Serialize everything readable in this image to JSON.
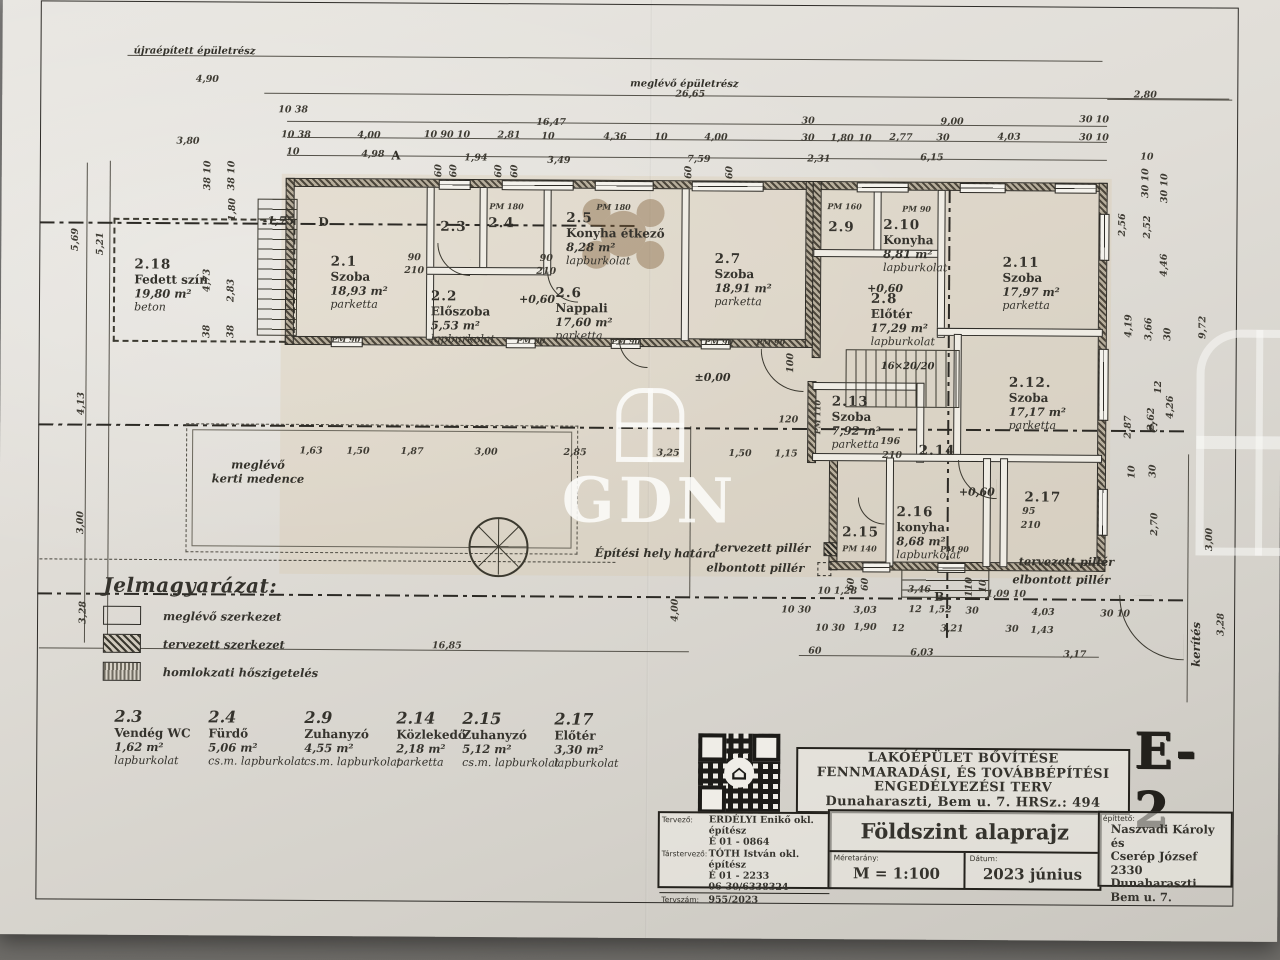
{
  "sheet": {
    "code": "E-2",
    "watermark": "GDN",
    "project_title_lines": [
      "LAKÓÉPÜLET BŐVÍTÉSE",
      "FENNMARADÁSI, ÉS TOVÁBBÉPÍTÉSI",
      "ENGEDÉLYEZÉSI TERV",
      "Dunaharaszti, Bem u. 7. HRSz.: 494"
    ],
    "drawing_title": "Földszint alaprajz",
    "scale_label": "Méretarány:",
    "scale_value": "M = 1:100",
    "date_label": "Dátum:",
    "date_value": "2023 június",
    "designer_label": "Tervező:",
    "designer_lines": [
      "ERDÉLYI Enikő okl. építész",
      "É 01 - 0864"
    ],
    "codesigner_label": "Társtervező:",
    "codesigner_lines": [
      "TÓTH István okl. építész",
      "É 01 - 2233",
      "06-30/6338324"
    ],
    "plan_no_label": "Tervszám:",
    "plan_no": "955/2023",
    "client_label": "építtető:",
    "client_lines": [
      "Naszvadi Károly és",
      "Cserép József",
      "2330 Dunaharaszti",
      "Bem u. 7."
    ]
  },
  "legend": {
    "title": "Jelmagyarázat:",
    "items": [
      {
        "label": "meglévő szerkezet"
      },
      {
        "label": "tervezett szerkezet"
      },
      {
        "label": "homlokzati hőszigetelés"
      }
    ]
  },
  "room_list": [
    {
      "id": "2.3",
      "name": "Vendég WC",
      "area": "1,62 m²",
      "floor": "lapburkolat"
    },
    {
      "id": "2.4",
      "name": "Fürdő",
      "area": "5,06 m²",
      "floor": "cs.m. lapburkolat"
    },
    {
      "id": "2.9",
      "name": "Zuhanyzó",
      "area": "4,55 m²",
      "floor": "cs.m. lapburkolat"
    },
    {
      "id": "2.14",
      "name": "Közlekedő",
      "area": "2,18 m²",
      "floor": "parketta"
    },
    {
      "id": "2.15",
      "name": "Zuhanyzó",
      "area": "5,12 m²",
      "floor": "cs.m. lapburkolat"
    },
    {
      "id": "2.17",
      "name": "Előtér",
      "area": "3,30 m²",
      "floor": "lapburkolat"
    }
  ],
  "plan": {
    "rooms": [
      {
        "id": "2.18",
        "name": "Fedett szín",
        "area": "19,80 m²",
        "floor": "beton",
        "x": 170,
        "y": 292
      },
      {
        "id": "2.1",
        "name": "Szoba",
        "area": "18,93 m²",
        "floor": "parketta",
        "x": 358,
        "y": 288
      },
      {
        "id": "2.2",
        "name": "Előszoba",
        "area": "5,53 m²",
        "floor": "lapburkolat",
        "x": 462,
        "y": 322
      },
      {
        "id": "2.3",
        "x": 452,
        "y": 232
      },
      {
        "id": "2.4",
        "x": 500,
        "y": 228
      },
      {
        "id": "2.5",
        "name": "Konyha étkező",
        "area": "8,28 m²",
        "floor": "lapburkolat",
        "x": 614,
        "y": 243
      },
      {
        "id": "2.6",
        "name": "Nappali",
        "area": "17,60 m²",
        "floor": "parketta",
        "x": 583,
        "y": 318
      },
      {
        "id": "2.7",
        "name": "Szoba",
        "area": "18,91 m²",
        "floor": "parketta",
        "x": 742,
        "y": 283
      },
      {
        "id": "2.8",
        "name": "Előtér",
        "area": "17,29 m²",
        "floor": "lapburkolat",
        "x": 902,
        "y": 322
      },
      {
        "id": "2.9",
        "x": 840,
        "y": 230
      },
      {
        "id": "2.10",
        "name": "Konyha",
        "area": "8,81 m²",
        "floor": "lapburkolat",
        "x": 914,
        "y": 248
      },
      {
        "id": "2.11",
        "name": "Szoba",
        "area": "17,97 m²",
        "floor": "parketta",
        "x": 1030,
        "y": 285
      },
      {
        "id": "2.12.",
        "name": "Szoba",
        "area": "17,17 m²",
        "floor": "parketta",
        "x": 1037,
        "y": 405
      },
      {
        "id": "2.13",
        "name": "Szoba",
        "area": "7,92 m²",
        "floor": "parketta",
        "x": 856,
        "y": 425
      },
      {
        "id": "2.14",
        "x": 937,
        "y": 453
      },
      {
        "id": "2.15",
        "x": 861,
        "y": 535
      },
      {
        "id": "2.16",
        "name": "konyha",
        "area": "8,68 m²",
        "floor": "lapburkolat",
        "x": 929,
        "y": 535
      },
      {
        "id": "2.17",
        "x": 1043,
        "y": 499
      }
    ],
    "dim_labels": [
      {
        "t": "4,90",
        "x": 205,
        "y": 86
      },
      {
        "t": "26,65",
        "x": 688,
        "y": 98
      },
      {
        "t": "2,80",
        "x": 1143,
        "y": 96
      },
      {
        "t": "16,47",
        "x": 549,
        "y": 127
      },
      {
        "t": "9,00",
        "x": 950,
        "y": 124
      },
      {
        "t": "30",
        "x": 806,
        "y": 124
      },
      {
        "t": "30 10",
        "x": 1092,
        "y": 121
      },
      {
        "t": "10 38",
        "x": 291,
        "y": 116
      },
      {
        "t": "10 38",
        "x": 294,
        "y": 141
      },
      {
        "t": "10",
        "x": 291,
        "y": 158
      },
      {
        "t": "4,00",
        "x": 367,
        "y": 141
      },
      {
        "t": "10 90 10",
        "x": 445,
        "y": 140
      },
      {
        "t": "2,81",
        "x": 507,
        "y": 140
      },
      {
        "t": "10",
        "x": 546,
        "y": 141
      },
      {
        "t": "4,36",
        "x": 613,
        "y": 141
      },
      {
        "t": "10",
        "x": 659,
        "y": 141
      },
      {
        "t": "4,00",
        "x": 714,
        "y": 141
      },
      {
        "t": "30",
        "x": 806,
        "y": 141
      },
      {
        "t": "1,80",
        "x": 840,
        "y": 141
      },
      {
        "t": "10",
        "x": 863,
        "y": 141
      },
      {
        "t": "2,77",
        "x": 899,
        "y": 140
      },
      {
        "t": "30",
        "x": 941,
        "y": 140
      },
      {
        "t": "4,03",
        "x": 1007,
        "y": 139
      },
      {
        "t": "30 10",
        "x": 1092,
        "y": 139
      },
      {
        "t": "4,98",
        "x": 371,
        "y": 160
      },
      {
        "t": "1,94",
        "x": 474,
        "y": 163
      },
      {
        "t": "3,49",
        "x": 557,
        "y": 165
      },
      {
        "t": "7,59",
        "x": 697,
        "y": 163
      },
      {
        "t": "2,31",
        "x": 817,
        "y": 162
      },
      {
        "t": "6,15",
        "x": 930,
        "y": 160
      },
      {
        "t": "10",
        "x": 1145,
        "y": 158
      },
      {
        "t": "3,80",
        "x": 186,
        "y": 148
      },
      {
        "t": "60",
        "x": 437,
        "y": 176,
        "v": 1
      },
      {
        "t": "60",
        "x": 452,
        "y": 176,
        "v": 1
      },
      {
        "t": "60",
        "x": 497,
        "y": 176,
        "v": 1
      },
      {
        "t": "60",
        "x": 513,
        "y": 176,
        "v": 1
      },
      {
        "t": "60",
        "x": 687,
        "y": 176,
        "v": 1
      },
      {
        "t": "60",
        "x": 728,
        "y": 176,
        "v": 1
      },
      {
        "t": "5,69",
        "x": 74,
        "y": 247,
        "v": 1
      },
      {
        "t": "5,21",
        "x": 99,
        "y": 251,
        "v": 1
      },
      {
        "t": "38 10",
        "x": 206,
        "y": 182,
        "v": 1
      },
      {
        "t": "38 10",
        "x": 230,
        "y": 182,
        "v": 1
      },
      {
        "t": "1,80",
        "x": 231,
        "y": 216,
        "v": 1
      },
      {
        "t": "4,73",
        "x": 206,
        "y": 287,
        "v": 1
      },
      {
        "t": "2,83",
        "x": 230,
        "y": 297,
        "v": 1
      },
      {
        "t": "38",
        "x": 206,
        "y": 338,
        "v": 1
      },
      {
        "t": "38",
        "x": 230,
        "y": 338,
        "v": 1
      },
      {
        "t": "4,13",
        "x": 81,
        "y": 411,
        "v": 1
      },
      {
        "t": "3,00",
        "x": 81,
        "y": 530,
        "v": 1
      },
      {
        "t": "3,28",
        "x": 84,
        "y": 620,
        "v": 1
      },
      {
        "t": "1,63",
        "x": 311,
        "y": 457
      },
      {
        "t": "1,50",
        "x": 358,
        "y": 457
      },
      {
        "t": "1,87",
        "x": 412,
        "y": 457
      },
      {
        "t": "3,00",
        "x": 486,
        "y": 457
      },
      {
        "t": "2,85",
        "x": 575,
        "y": 457
      },
      {
        "t": "3,25",
        "x": 668,
        "y": 457
      },
      {
        "t": "1,50",
        "x": 740,
        "y": 457
      },
      {
        "t": "1,15",
        "x": 786,
        "y": 457
      },
      {
        "t": "2,56",
        "x": 1121,
        "y": 226,
        "v": 1
      },
      {
        "t": "2,52",
        "x": 1146,
        "y": 228,
        "v": 1
      },
      {
        "t": "4,46",
        "x": 1163,
        "y": 266,
        "v": 1
      },
      {
        "t": "30 10",
        "x": 1144,
        "y": 184,
        "v": 1
      },
      {
        "t": "30 10",
        "x": 1163,
        "y": 189,
        "v": 1
      },
      {
        "t": "4,19",
        "x": 1128,
        "y": 327,
        "v": 1
      },
      {
        "t": "3,66",
        "x": 1148,
        "y": 330,
        "v": 1
      },
      {
        "t": "30",
        "x": 1167,
        "y": 335,
        "v": 1
      },
      {
        "t": "9,72",
        "x": 1202,
        "y": 328,
        "v": 1
      },
      {
        "t": "2,87",
        "x": 1128,
        "y": 428,
        "v": 1
      },
      {
        "t": "2,62",
        "x": 1151,
        "y": 420,
        "v": 1
      },
      {
        "t": "12",
        "x": 1158,
        "y": 388,
        "v": 1
      },
      {
        "t": "4,26",
        "x": 1170,
        "y": 408,
        "v": 1
      },
      {
        "t": "30",
        "x": 1153,
        "y": 472,
        "v": 1
      },
      {
        "t": "10",
        "x": 1132,
        "y": 473,
        "v": 1
      },
      {
        "t": "2,70",
        "x": 1155,
        "y": 525,
        "v": 1
      },
      {
        "t": "3,00",
        "x": 1210,
        "y": 540,
        "v": 1
      },
      {
        "t": "3,28",
        "x": 1222,
        "y": 625,
        "v": 1
      },
      {
        "t": "10 1,28",
        "x": 838,
        "y": 594
      },
      {
        "t": "60",
        "x": 852,
        "y": 587,
        "v": 1
      },
      {
        "t": "60",
        "x": 866,
        "y": 587,
        "v": 1
      },
      {
        "t": "3,46",
        "x": 920,
        "y": 592
      },
      {
        "t": "110",
        "x": 970,
        "y": 589,
        "v": 1
      },
      {
        "t": "10",
        "x": 984,
        "y": 588,
        "v": 1
      },
      {
        "t": "1,09 10",
        "x": 1007,
        "y": 596
      },
      {
        "t": "10 30",
        "x": 797,
        "y": 613
      },
      {
        "t": "3,03",
        "x": 866,
        "y": 613
      },
      {
        "t": "12",
        "x": 916,
        "y": 612
      },
      {
        "t": "1,52",
        "x": 941,
        "y": 612
      },
      {
        "t": "30",
        "x": 973,
        "y": 613
      },
      {
        "t": "4,03",
        "x": 1044,
        "y": 614
      },
      {
        "t": "30 10",
        "x": 1116,
        "y": 615
      },
      {
        "t": "10 30",
        "x": 831,
        "y": 631
      },
      {
        "t": "1,90",
        "x": 866,
        "y": 630
      },
      {
        "t": "12",
        "x": 899,
        "y": 631
      },
      {
        "t": "3,21",
        "x": 953,
        "y": 631
      },
      {
        "t": "30",
        "x": 1013,
        "y": 631
      },
      {
        "t": "1,43",
        "x": 1043,
        "y": 632
      },
      {
        "t": "60",
        "x": 816,
        "y": 654
      },
      {
        "t": "6,03",
        "x": 923,
        "y": 655
      },
      {
        "t": "3,17",
        "x": 1076,
        "y": 656
      },
      {
        "t": "16,85",
        "x": 448,
        "y": 651
      },
      {
        "t": "4,00",
        "x": 676,
        "y": 614,
        "v": 1
      },
      {
        "t": "196",
        "x": 890,
        "y": 444
      },
      {
        "t": "210",
        "x": 892,
        "y": 458
      },
      {
        "t": "95",
        "x": 1029,
        "y": 513
      },
      {
        "t": "210",
        "x": 1031,
        "y": 527
      },
      {
        "t": "90",
        "x": 413,
        "y": 263
      },
      {
        "t": "210",
        "x": 413,
        "y": 276
      },
      {
        "t": "90",
        "x": 545,
        "y": 263
      },
      {
        "t": "210",
        "x": 545,
        "y": 276
      },
      {
        "t": "100",
        "x": 790,
        "y": 366,
        "v": 1
      },
      {
        "t": "120",
        "x": 788,
        "y": 423
      }
    ],
    "pm_labels": [
      {
        "t": "PM 180",
        "x": 505,
        "y": 211
      },
      {
        "t": "PM 180",
        "x": 612,
        "y": 211
      },
      {
        "t": "PM 160",
        "x": 843,
        "y": 209
      },
      {
        "t": "PM 90",
        "x": 915,
        "y": 211
      },
      {
        "t": "PM 90",
        "x": 345,
        "y": 345
      },
      {
        "t": "PM 90",
        "x": 530,
        "y": 345
      },
      {
        "t": "PM 90",
        "x": 625,
        "y": 345
      },
      {
        "t": "PM 90",
        "x": 718,
        "y": 345
      },
      {
        "t": "PM 90",
        "x": 770,
        "y": 345
      },
      {
        "t": "PM 140",
        "x": 860,
        "y": 551
      },
      {
        "t": "PM 90",
        "x": 955,
        "y": 551
      },
      {
        "t": "PM 110",
        "x": 817,
        "y": 420,
        "v": 1
      }
    ],
    "levels": [
      {
        "t": "+0,60",
        "x": 536,
        "y": 304
      },
      {
        "t": "+0,60",
        "x": 884,
        "y": 291
      },
      {
        "t": "+0,60",
        "x": 977,
        "y": 494
      },
      {
        "t": "±0,00",
        "x": 712,
        "y": 381
      },
      {
        "t": "-1,75",
        "x": 277,
        "y": 227
      }
    ],
    "axes": [
      {
        "t": "D",
        "x": 322,
        "y": 228
      },
      {
        "t": "A",
        "x": 394,
        "y": 161
      },
      {
        "t": "C",
        "x": 1153,
        "y": 429
      },
      {
        "t": "B",
        "x": 940,
        "y": 599
      }
    ],
    "annotations": [
      {
        "t": "újraépített épületrész",
        "x": 192,
        "y": 58,
        "cls": "sm"
      },
      {
        "t": "meglévő épületrész",
        "x": 682,
        "y": 88,
        "cls": "sm"
      },
      {
        "t": "Építési hely határa",
        "x": 656,
        "y": 557
      },
      {
        "t": "tervezett pillér",
        "x": 763,
        "y": 551
      },
      {
        "t": "elbontott pillér",
        "x": 756,
        "y": 571
      },
      {
        "t": "tervezett pillér",
        "x": 1067,
        "y": 563
      },
      {
        "t": "elbontott pillér",
        "x": 1062,
        "y": 581
      },
      {
        "t": "meglévő\nkerti medence",
        "x": 258,
        "y": 478
      },
      {
        "t": "kerítés",
        "x": 1197,
        "y": 645,
        "v": 1
      },
      {
        "t": "16×20/20",
        "x": 907,
        "y": 369,
        "cls": "sm"
      }
    ]
  }
}
